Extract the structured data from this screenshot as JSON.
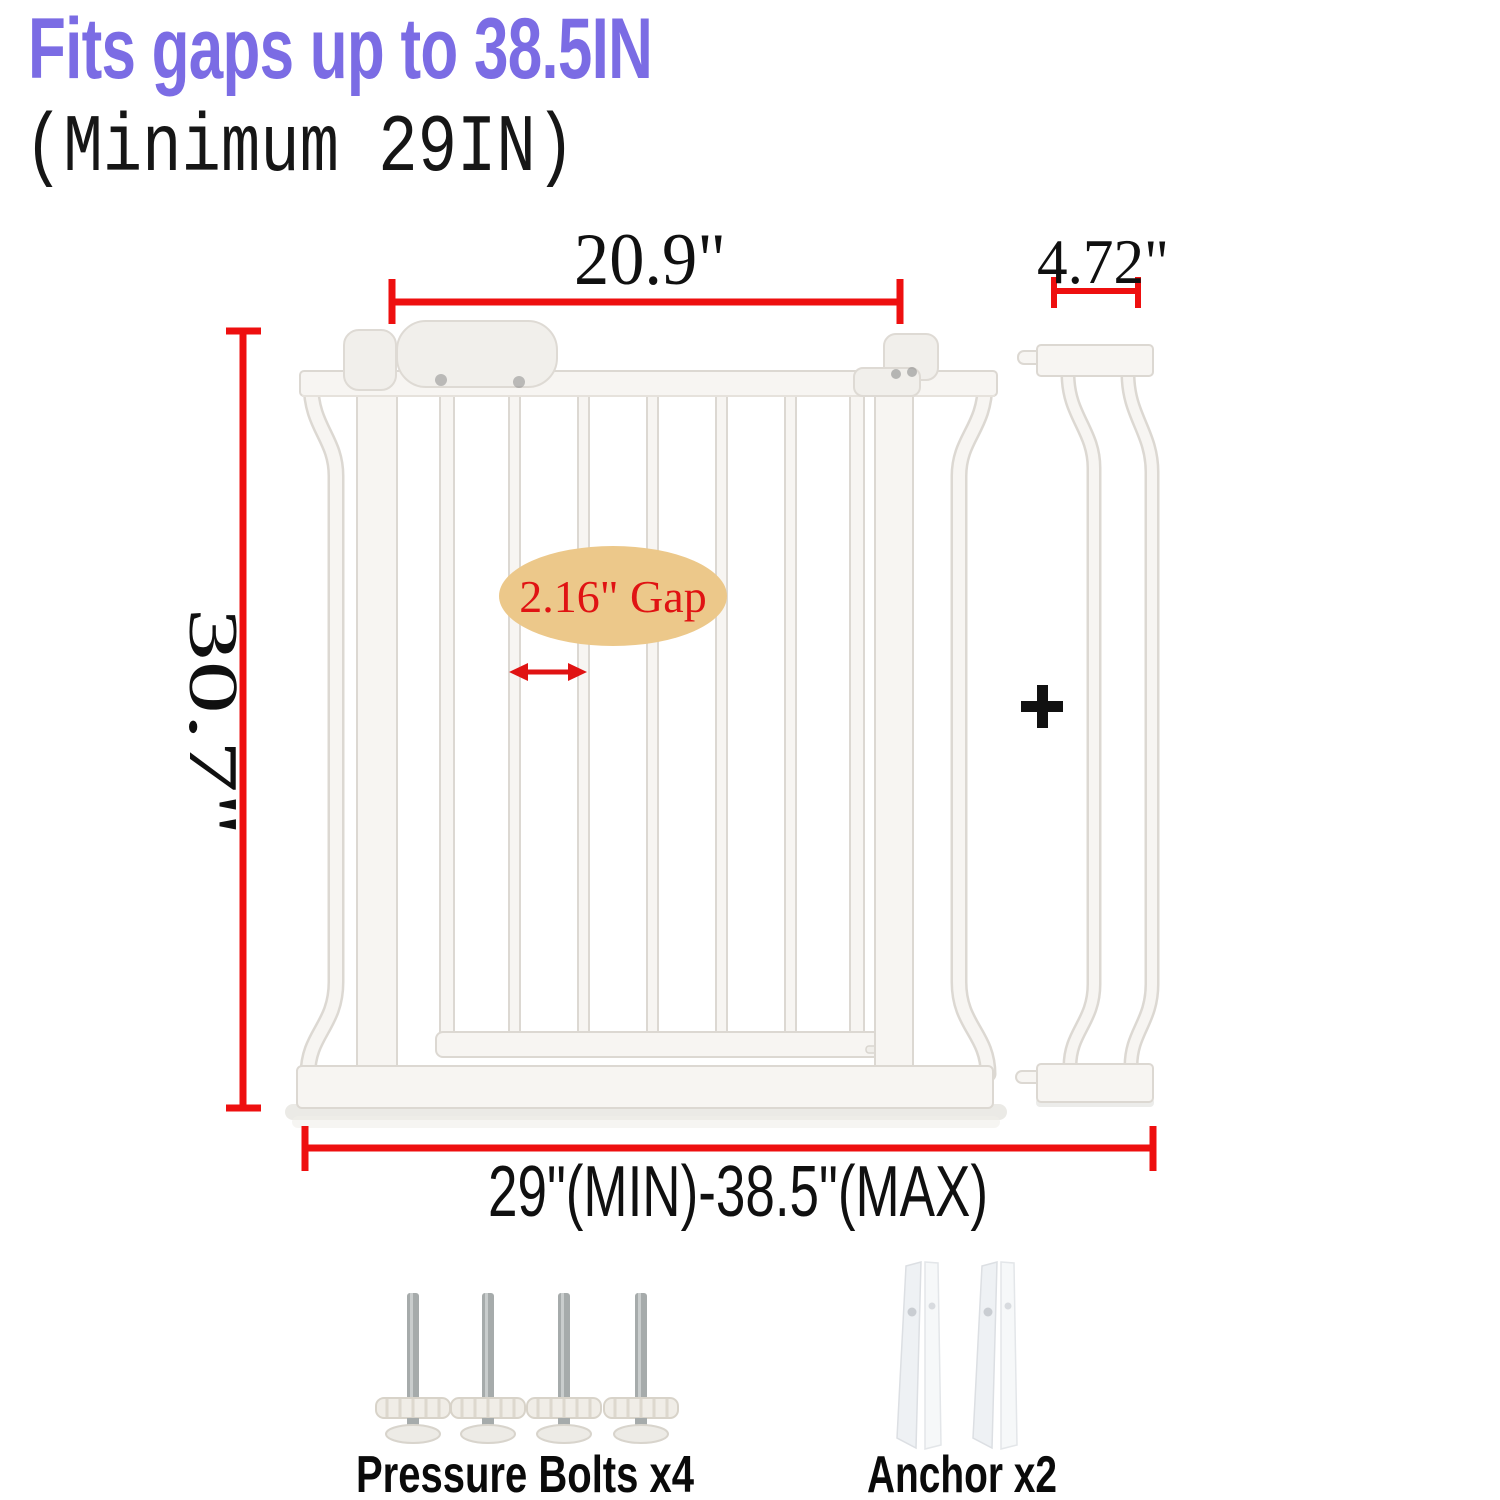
{
  "header": {
    "title": "Fits gaps up to 38.5IN",
    "subtitle": "(Minimum 29IN)"
  },
  "diagram": {
    "gate_width_label": "20.9\"",
    "extension_width_label": "4.72\"",
    "gate_height_label": "30.7\"",
    "fit_range_label": "29\"(MIN)-38.5\"(MAX)",
    "bar_gap_label": "2.16\" Gap",
    "plus_label": "+"
  },
  "parts": {
    "pressure_bolts_label": "Pressure Bolts x4",
    "anchor_label": "Anchor x2"
  },
  "colors": {
    "title_purple": "#7b6ce4",
    "dimension_red": "#ee0f0f",
    "gap_ellipse_tan": "#ecc88a",
    "gap_text_red": "#e01313",
    "label_black": "#101010",
    "gate_white": "#f7f5f2",
    "gate_edge_gray": "#dcd8d2"
  }
}
